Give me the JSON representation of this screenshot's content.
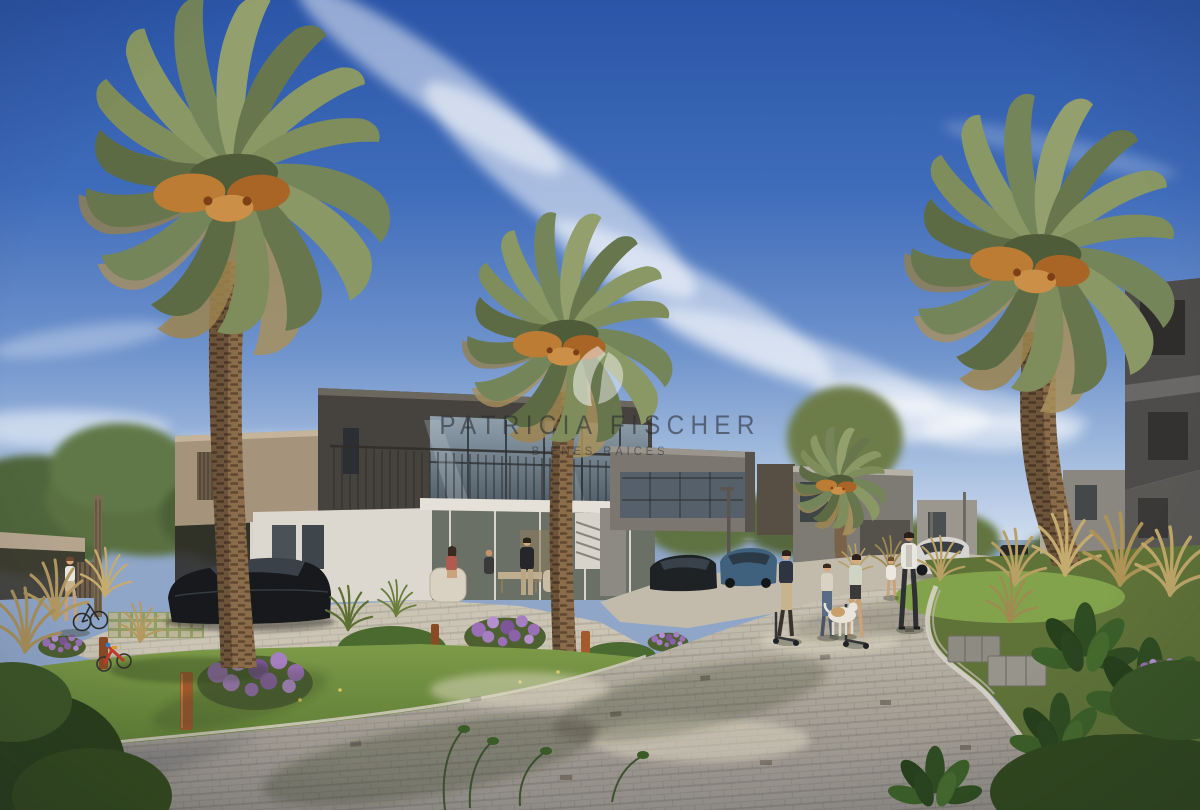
{
  "watermark": {
    "title": "PATRICIA FISCHER",
    "subtitle": "BIENES RAICES"
  },
  "scene": {
    "type": "architectural-rendering",
    "description": "Sunny rendering of a modern villa community: large date palms, two-story flat-roof houses, curved paver street, garden beds, residents and parked cars under a blue sky with wispy cirrus streaks",
    "people": [
      "woman walking a bicycle",
      "children on scooters",
      "dog",
      "man walking with toddler",
      "residents on villa patio"
    ],
    "vehicles": [
      "dark sedan",
      "dark hatchback",
      "blue sedan",
      "white SUV"
    ]
  },
  "palette": {
    "sky_top": "#2b55a8",
    "sky_horizon": "#cfdcee",
    "cloud": "#ffffff",
    "palm_frond": "#7f8c5c",
    "palm_dates": "#bd7c34",
    "palm_trunk": "#8a6c4b",
    "building_charcoal": "#46433f",
    "building_gray": "#7b766f",
    "building_beige": "#a5937c",
    "wall_white": "#dcd8cf",
    "glass": "#5d6a74",
    "paver_light": "#cfc8b9",
    "paver_shade": "#8f8b86",
    "grass": "#6f8f3f",
    "shrub_dark": "#31481f",
    "flower_purple": "#9a6fb5",
    "bollard_rust": "#a35b2e",
    "car_dark": "#17191c",
    "car_blue": "#3f617d",
    "car_white": "#d6d5d1"
  }
}
